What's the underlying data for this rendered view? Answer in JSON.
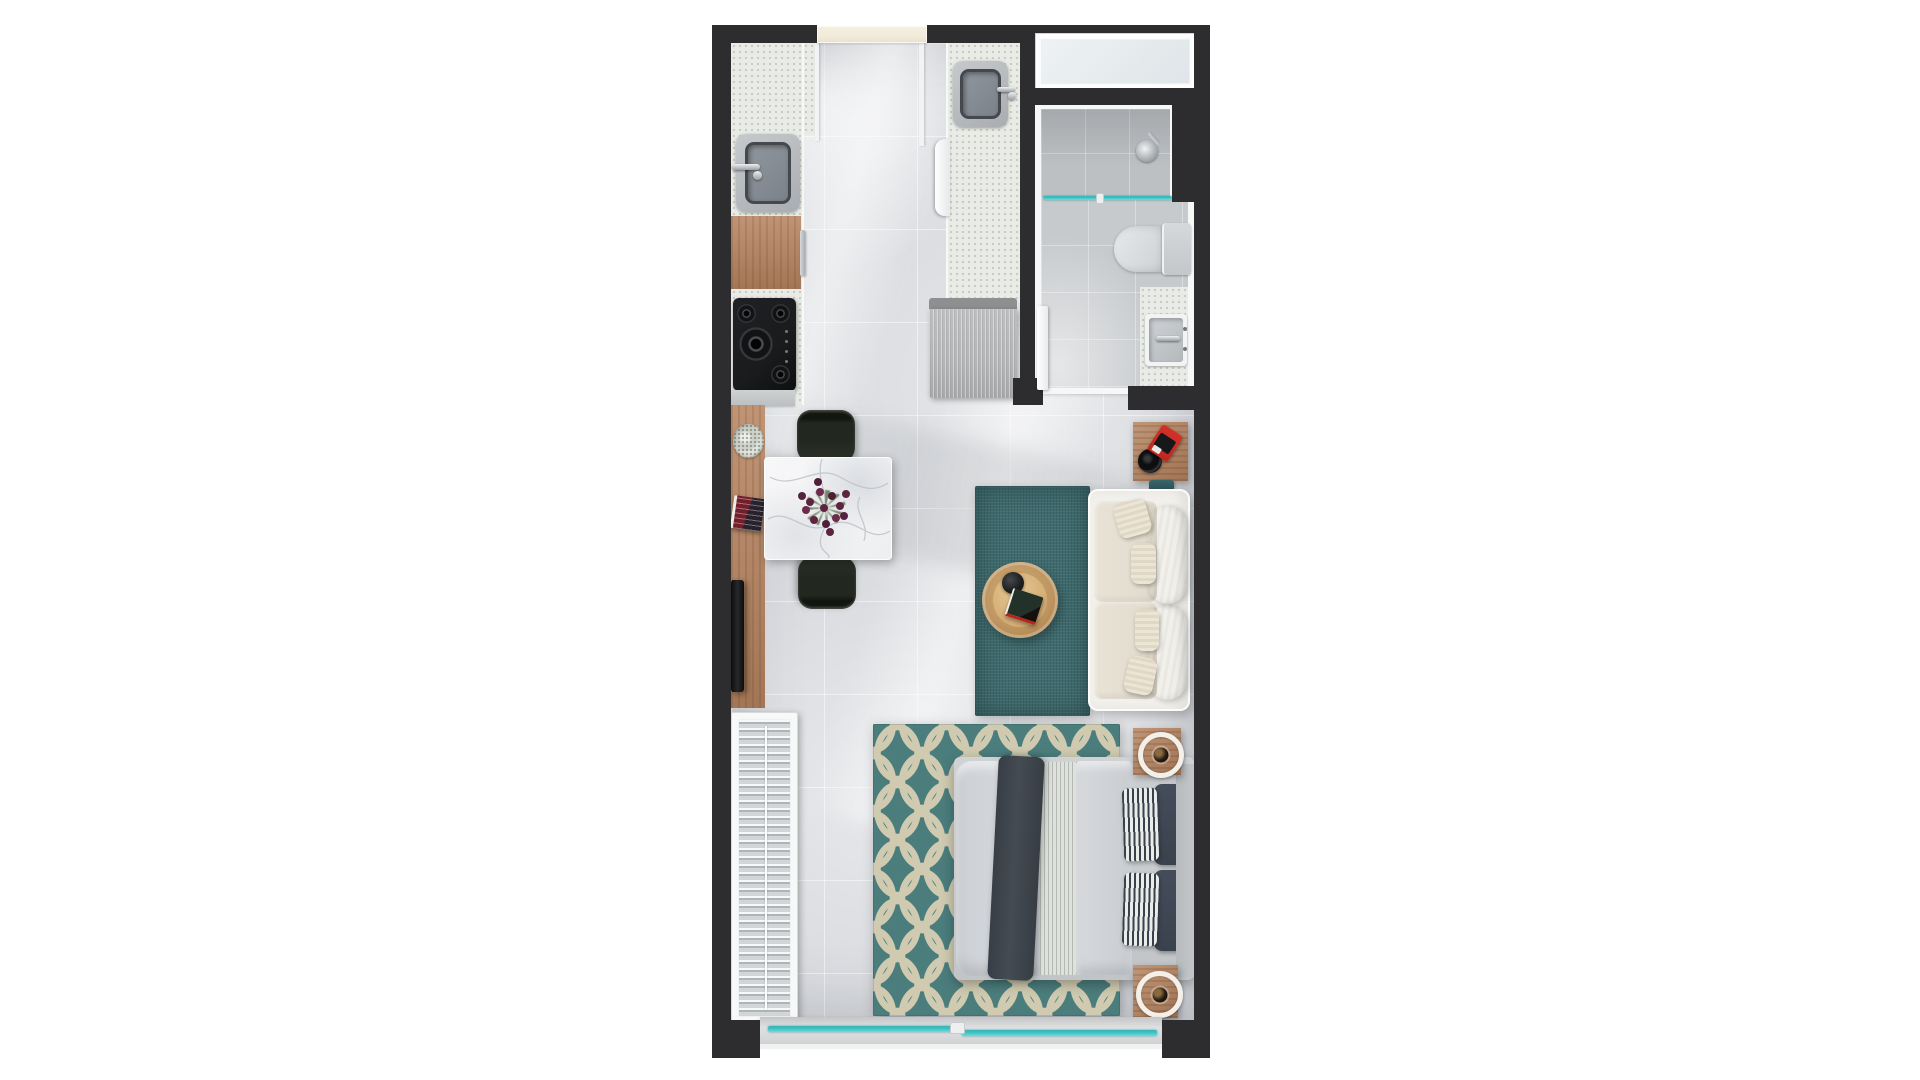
{
  "document": {
    "type": "apartment-floor-plan-render",
    "view": "top-down",
    "style": "3d-rendered studio apartment plan on white background"
  },
  "scene": {
    "rooms": [
      {
        "id": "kitchen",
        "area": "top-left"
      },
      {
        "id": "bathroom",
        "area": "top-right"
      },
      {
        "id": "living-dining-area",
        "area": "middle"
      },
      {
        "id": "sleeping-area",
        "area": "bottom"
      },
      {
        "id": "balcony-doorway",
        "area": "bottom-edge"
      }
    ],
    "furniture": [
      "kitchen-counter",
      "kitchen-sink",
      "base-cabinet-wood",
      "cooktop",
      "island-counter",
      "island-sink",
      "washer-door",
      "hall-cabinet",
      "entry-door",
      "window",
      "shower",
      "shower-glass",
      "toilet",
      "vanity",
      "vanity-sink",
      "bathroom-door",
      "dining-table",
      "dining-chair",
      "dining-chair",
      "flower-centerpiece",
      "tv-sideboard",
      "tv",
      "wreath-decor",
      "book-stack",
      "side-table",
      "speaker",
      "radio",
      "area-rug-teal",
      "coffee-table",
      "tray",
      "coffee-table-books",
      "sofa",
      "seat-cushions",
      "back-pillows",
      "accent-pillows",
      "wardrobe-with-clothes",
      "patterned-rug",
      "double-bed",
      "duvet",
      "striped-sheet",
      "dark-throw",
      "striped-pillows",
      "navy-pillows",
      "headboard",
      "nightstand",
      "nightstand",
      "candle-plate",
      "candle-plate",
      "sliding-glass-door",
      "door-handle"
    ]
  },
  "colors": {
    "wall": "#2d2d2f",
    "floor": "#d7d9dd",
    "floor_light": "#eceef0",
    "counter": "#e9ebe6",
    "wood": "#b5835f",
    "wood_dark": "#8f6242",
    "steel": "#b4b8bc",
    "sink_rim": "#45494e",
    "sink_basin": "#8f969d",
    "chrome": "#d9dcde",
    "appliance_black": "#1a1b1d",
    "gray_cabinet": "#b3b5b7",
    "door_cream": "#f1ebda",
    "glass_teal": "#43c3c6",
    "bath_floor": "#c7cacd",
    "shower_floor": "#bdc0c3",
    "porcelain": "#dadde0",
    "frame_white": "#f6f7f7",
    "rug_teal": "#3f6b6e",
    "rug_pattern_bg": "#4b7d7c",
    "rug_pattern_line": "#d6cfb3",
    "sofa_frame": "#f2f0eb",
    "cushion": "#e9e2d6",
    "pillow_white": "#f7f4ee",
    "pillow_accent": "#e0d8c6",
    "duvet": "#d2d5d9",
    "sheet": "#dfe1dc",
    "throw_dark": "#454b53",
    "pillow_navy": "#3a424e",
    "pillow_stripe_light": "#eaece9",
    "headboard": "#c3c6c9",
    "marble": "#f5f5f6",
    "chair_dark": "#22271f",
    "flower_plum": "#5c2440",
    "leaf_green": "#5f7452",
    "table_wood": "#d3ab74",
    "tray_black": "#1b1c1e",
    "radio_red": "#c1271e",
    "sill": "#d0d2d3",
    "candle_dark": "#241a11"
  }
}
